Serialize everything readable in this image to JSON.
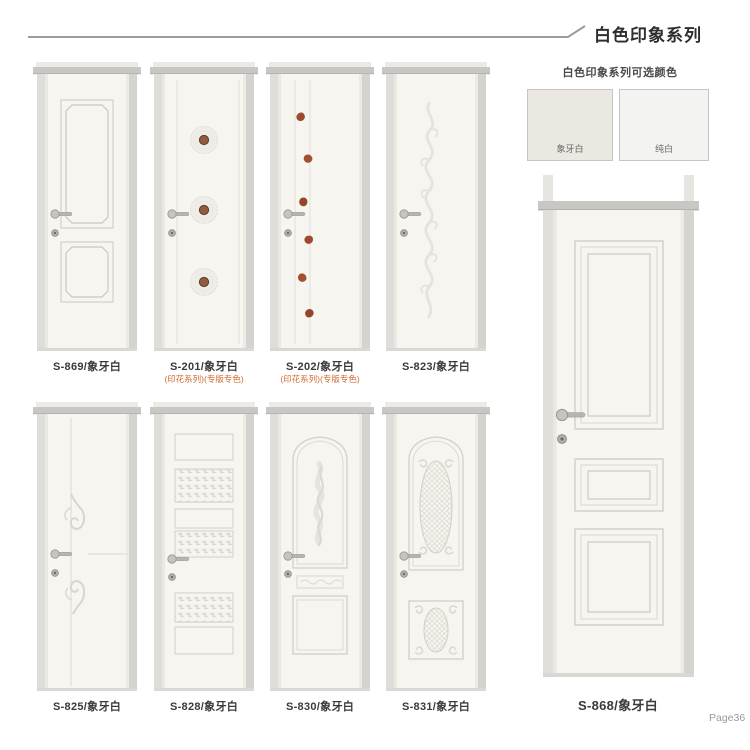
{
  "page": {
    "title": "白色印象系列",
    "page_number": "Page36"
  },
  "swatches": {
    "title": "白色印象系列可选颜色",
    "items": [
      {
        "label": "象牙白",
        "color": "#eae8e0"
      },
      {
        "label": "纯白",
        "color": "#f3f3f1"
      }
    ]
  },
  "doors": [
    {
      "id": "S-869",
      "label": "S-869/象牙白",
      "sublabel": "",
      "style": "two-panel"
    },
    {
      "id": "S-201",
      "label": "S-201/象牙白",
      "sublabel": "(印花系列)(专版专色)",
      "style": "lace-medallions"
    },
    {
      "id": "S-202",
      "label": "S-202/象牙白",
      "sublabel": "(印花系列)(专版专色)",
      "style": "leaf-motifs"
    },
    {
      "id": "S-823",
      "label": "S-823/象牙白",
      "sublabel": "",
      "style": "embossed-vine"
    },
    {
      "id": "S-825",
      "label": "S-825/象牙白",
      "sublabel": "",
      "style": "scroll-flourish"
    },
    {
      "id": "S-828",
      "label": "S-828/象牙白",
      "sublabel": "",
      "style": "carved-slats"
    },
    {
      "id": "S-830",
      "label": "S-830/象牙白",
      "sublabel": "",
      "style": "arch-floral"
    },
    {
      "id": "S-831",
      "label": "S-831/象牙白",
      "sublabel": "",
      "style": "oval-lattice"
    }
  ],
  "featured_door": {
    "id": "S-868",
    "label": "S-868/象牙白",
    "style": "three-panel"
  },
  "palette": {
    "door_face": "#f6f5f0",
    "door_frame": "#c8c7c3",
    "engraving_line": "#d5d2cb",
    "accent_red_text": "#d06a33",
    "medallion_center": "#8f5a41",
    "leaf_motif": "#9d4b2e",
    "header_line": "#9c9c9c"
  }
}
